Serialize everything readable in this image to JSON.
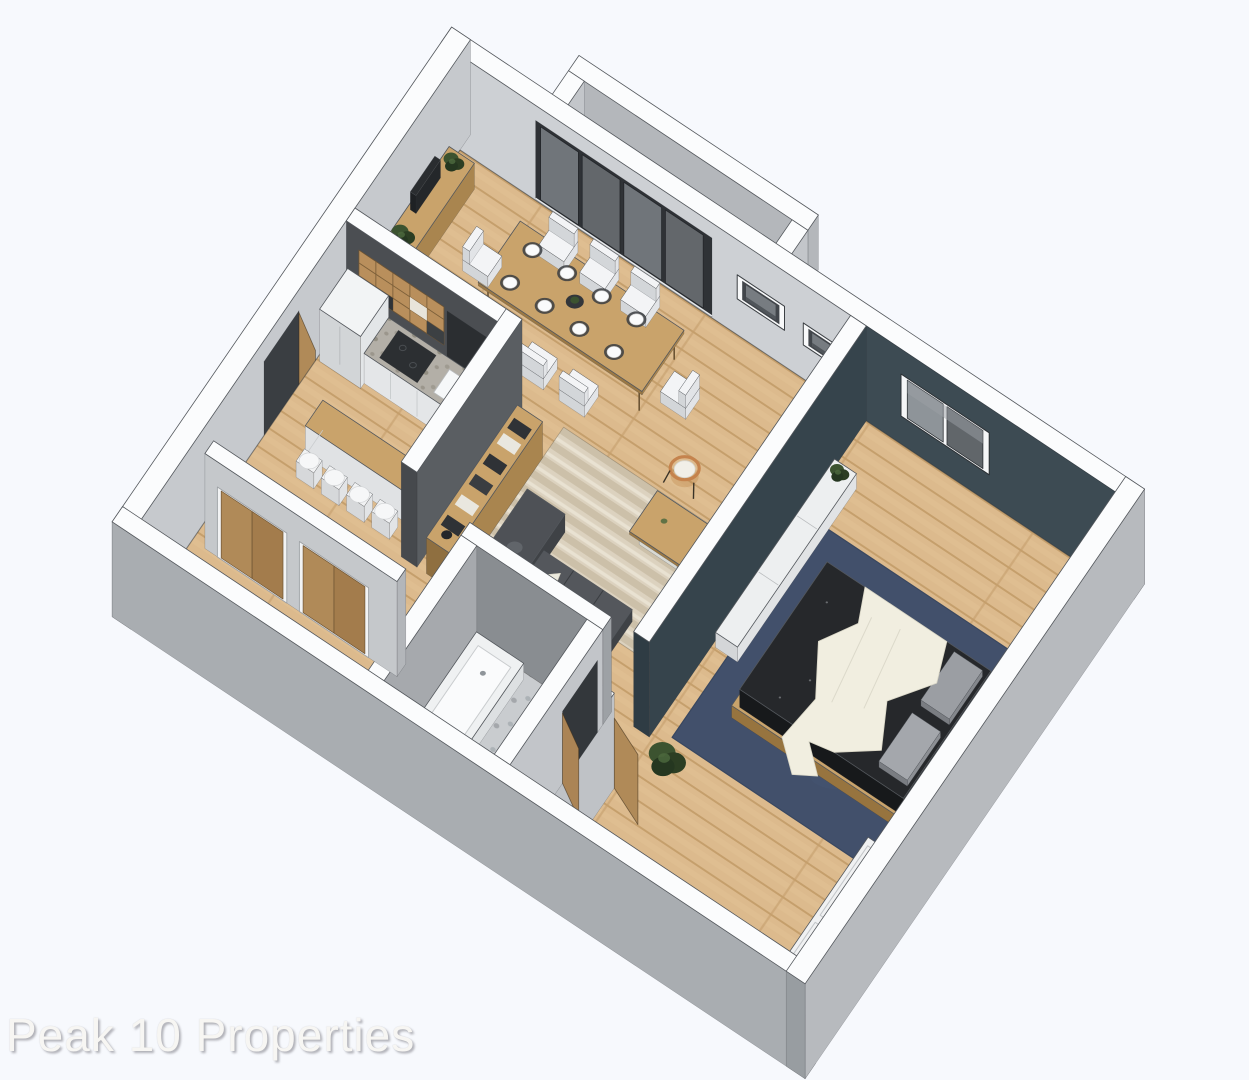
{
  "watermark": {
    "text": "Peak 10 Properties"
  },
  "figure": {
    "kind": "isometric-3d-floor-plan-rendering"
  },
  "palette": {
    "background": "#f7f9fd",
    "wallTop": "#fbfcfd",
    "wallEdge": "#53575c",
    "wallFaceLight": "#cdd0d4",
    "wallFaceMid": "#c0c3c7",
    "wallFaceDark": "#a9adb1",
    "wallOuterSE": "#b7babe",
    "wallCap": "#989da1",
    "charcoal": "#4b4e52",
    "charcoalLight": "#5a5e62",
    "teal": "#3d4b53",
    "tealSide": "#36444c",
    "tealDark": "#2f3c44",
    "woodFloor": "#dcba8d",
    "woodLine": "#bf9864",
    "deck": "#c69d68",
    "deckLine": "#7e5f3a",
    "furnWood": "#c9a36b",
    "furnWoodDark": "#a9854f",
    "doorWood": "#b08a58",
    "sofaTop": "#4e5156",
    "sofaFront": "#3f4246",
    "sofaSide": "#35383c",
    "rugBeige": "#dcd2bf",
    "rugBeigeDark": "#ccc0a9",
    "rugBeigeLight": "#e9e2d2",
    "rugNavy": "#42506b",
    "bedDark": "#232527",
    "blanket": "#f1eee0",
    "pillow": "#9b9ea3",
    "white": "#f2f3f4",
    "whiteSide": "#e0e2e4",
    "graniteTop": "#b3afa7",
    "graniteDot": "#8a8679",
    "tile": "#c9cccf",
    "tileDot": "#9aa0a5",
    "glass": "#63676b",
    "glassLight": "#8e9499",
    "frameDark": "#2f3236",
    "plantDark": "#2c3e23",
    "plantMid": "#3c5330",
    "plantDeep": "#253720",
    "accentOrange": "#c5834d",
    "watermark": "#f7f6f3"
  }
}
